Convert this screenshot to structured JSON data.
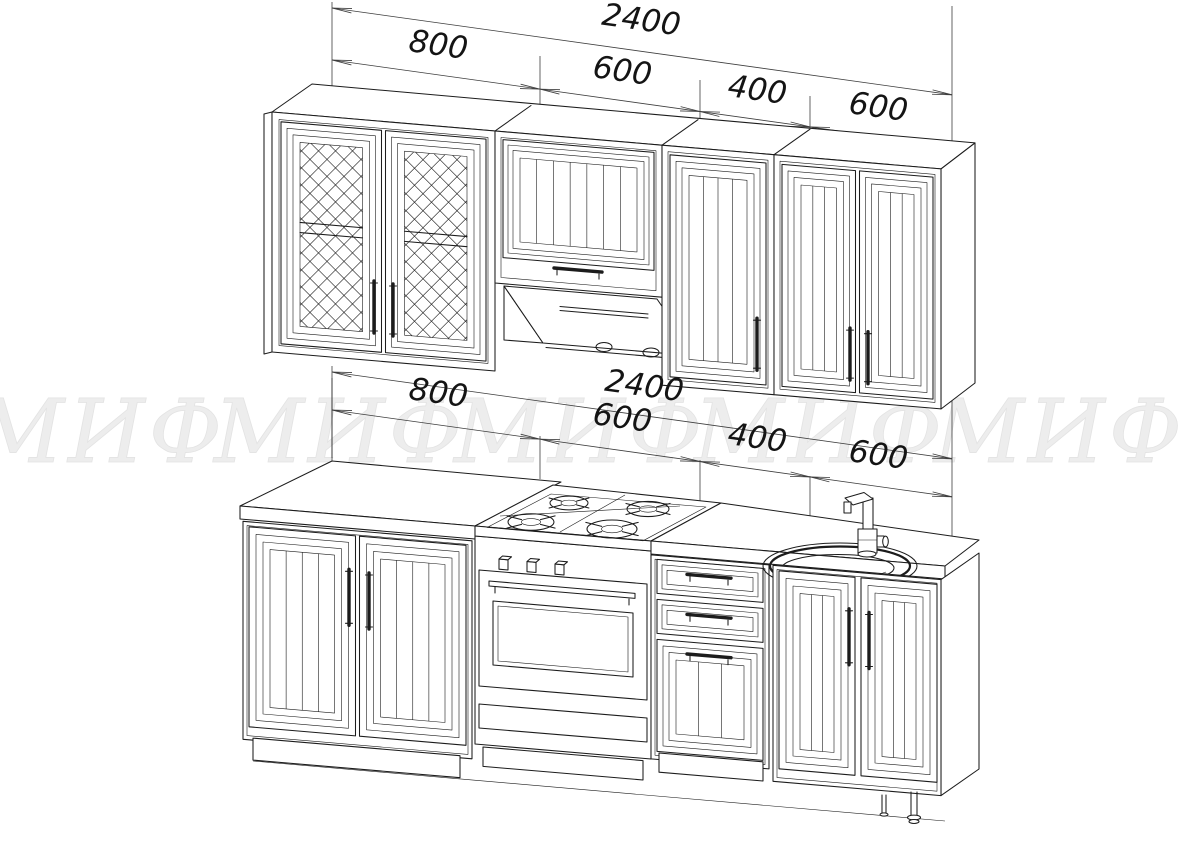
{
  "colors": {
    "background": "#ffffff",
    "line": "#1c1c1c",
    "dimension": "#3d3d3d",
    "watermark": "#ededed"
  },
  "watermark": {
    "text": "МИФ"
  },
  "dims": {
    "upper": {
      "overall": "2400",
      "segments": [
        "800",
        "600",
        "400",
        "600"
      ]
    },
    "lower": {
      "overall": "2400",
      "segments": [
        "800",
        "600",
        "400",
        "600"
      ]
    }
  }
}
